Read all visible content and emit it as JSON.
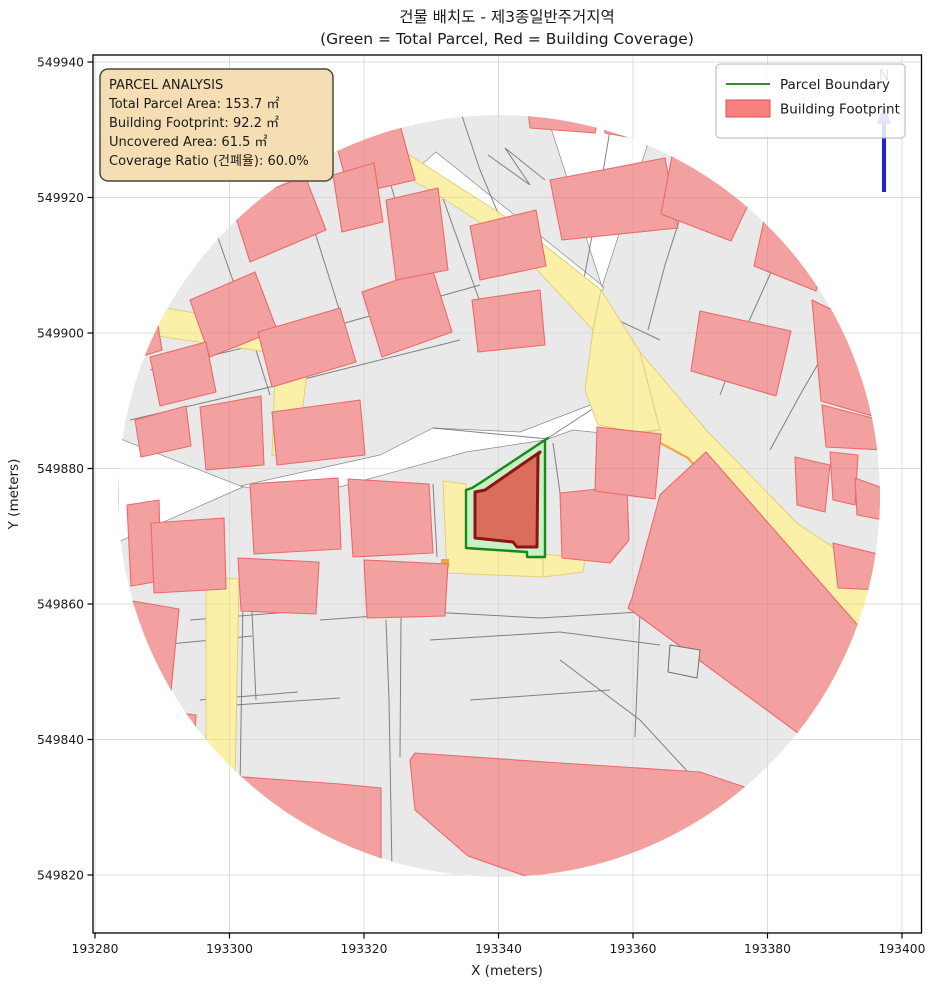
{
  "figure": {
    "title": "건물 배치도 - 제3종일반주거지역",
    "subtitle": "(Green = Total Parcel, Red = Building Coverage)",
    "x_axis": {
      "label": "X (meters)",
      "ticks": [
        "193280",
        "193300",
        "193320",
        "193340",
        "193360",
        "193380",
        "193400"
      ]
    },
    "y_axis": {
      "label": "Y (meters)",
      "ticks": [
        "549940",
        "549920",
        "549900",
        "549880",
        "549860",
        "549840",
        "549820"
      ]
    }
  },
  "analysis_box": {
    "title": "PARCEL ANALYSIS",
    "total_parcel_area": "Total Parcel Area: 153.7 ㎡",
    "building_footprint": "Building Footprint: 92.2 ㎡",
    "uncovered_area": "Uncovered Area: 61.5 ㎡",
    "coverage_ratio": "Coverage Ratio (건폐율): 60.0%"
  },
  "legend": {
    "parcel_boundary_label": "Parcel Boundary",
    "building_footprint_label": "Building Footprint"
  },
  "north_arrow_label": "N",
  "colors": {
    "parcel_boundary_green": "#178a17",
    "parcel_fill_green": "#c9f0c6",
    "target_building_outline": "#8c1414",
    "target_building_fill": "#da6e5b",
    "surrounding_building_fill": "#f2a0a0",
    "surrounding_building_edge": "#ea6a6a",
    "road_fill_yellow": "#fbf0a8",
    "parcel_gray": "#e9e9e9",
    "north_arrow_blue": "#2222dd",
    "info_box_wheat": "#f5deb3"
  }
}
